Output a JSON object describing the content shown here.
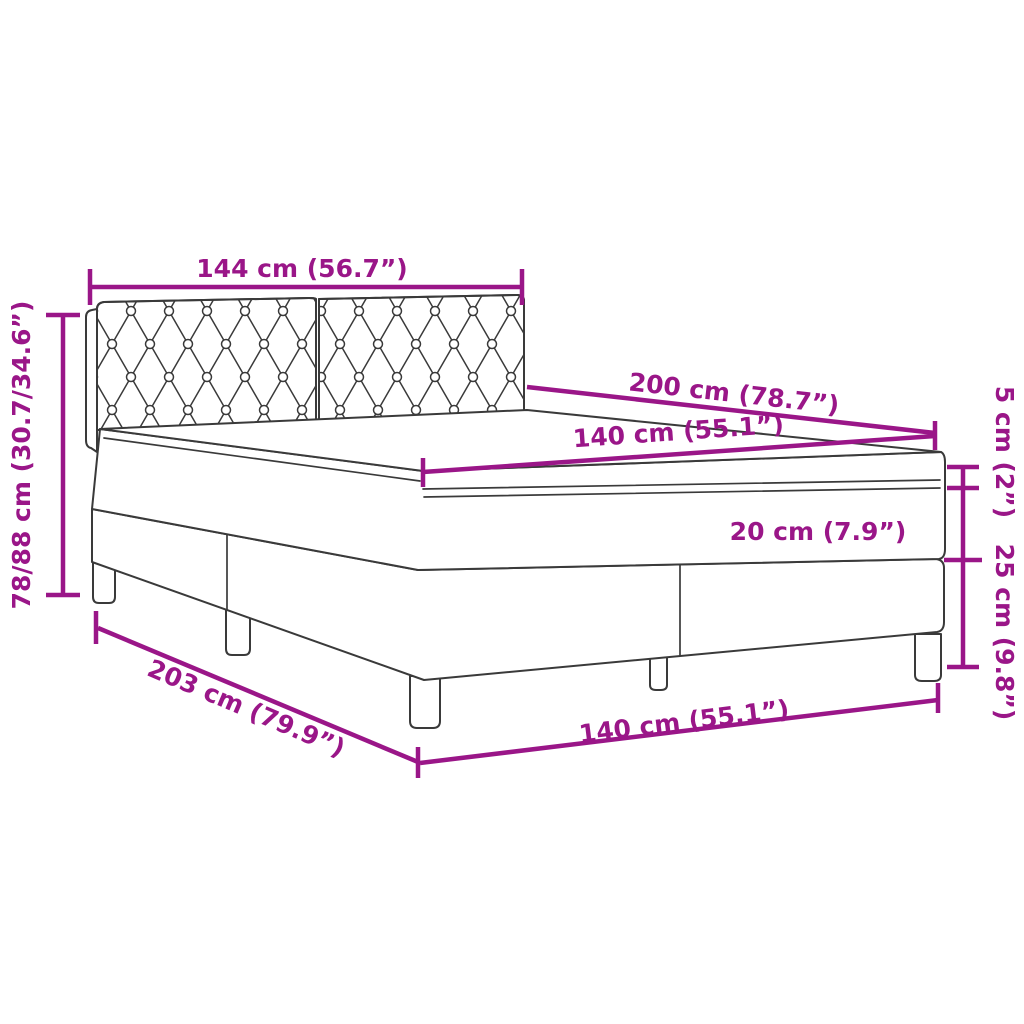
{
  "colors": {
    "dimension": "#9A1688",
    "line_art": "#3A3A3A",
    "background": "#FFFFFF"
  },
  "diagram": {
    "kind": "product-dimension-diagram",
    "subject": "box spring bed with tufted headboard"
  },
  "labels": {
    "headboard_width": "144 cm (56.7”)",
    "bed_length": "200 cm (78.7”)",
    "mattress_width": "140 cm (55.1”)",
    "topper_height": "5 cm (2”)",
    "mattress_height": "20 cm (7.9”)",
    "base_height": "25 cm (9.8”)",
    "headboard_height": "78/88 cm (30.7/34.6”)",
    "total_length": "203 cm (79.9”)",
    "bed_width": "140 cm (55.1”)"
  }
}
